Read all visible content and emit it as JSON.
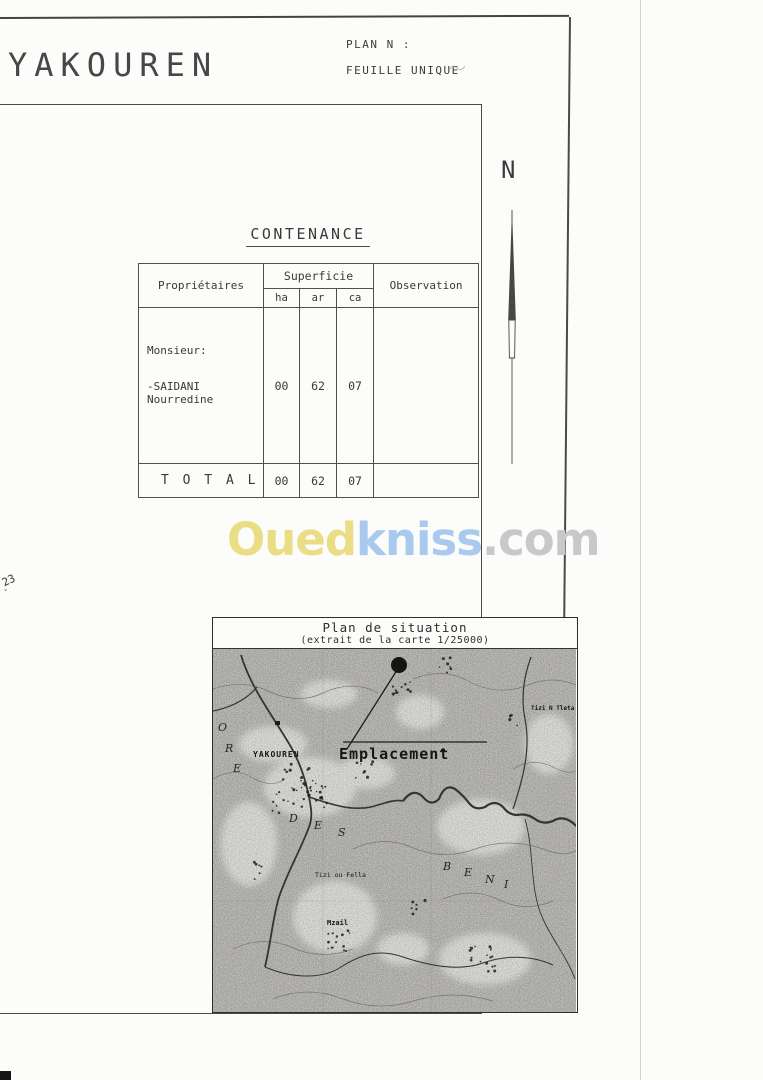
{
  "page": {
    "title": "YAKOUREN",
    "plan_no_label": "PLAN N :",
    "sheet_label": "FEUILLE UNIQUE",
    "north_label": "N",
    "margin_note": "23"
  },
  "contenance": {
    "heading": "CONTENANCE",
    "columns": {
      "owners": "Propriétaires",
      "area_group": "Superficie",
      "area_units": [
        "ha",
        "ar",
        "ca"
      ],
      "observation": "Observation"
    },
    "rows": [
      {
        "owner_prefix": "Monsieur:",
        "owner_name": "-SAIDANI Nourredine",
        "ha": "00",
        "ar": "62",
        "ca": "07",
        "observation": ""
      }
    ],
    "total": {
      "label": "T O T A L",
      "ha": "00",
      "ar": "62",
      "ca": "07",
      "observation": ""
    }
  },
  "watermark": {
    "part1": "Oued",
    "part2": "kniss",
    "part3": ".com",
    "color1": "#eadd85",
    "color2": "#a9c9ee",
    "color3": "#c8c8c8"
  },
  "situation_map": {
    "title": "Plan de situation",
    "subtitle": "(extrait de la carte 1/25000)",
    "marker_label": "Emplacement",
    "labels": [
      "YAKOUREN",
      "Tizi N Tleta",
      "Tizi ou Fella",
      "Mzail"
    ],
    "forest_letters": [
      "O",
      "R",
      "E",
      "D",
      "E",
      "S",
      "B",
      "E",
      "N",
      "I"
    ]
  }
}
